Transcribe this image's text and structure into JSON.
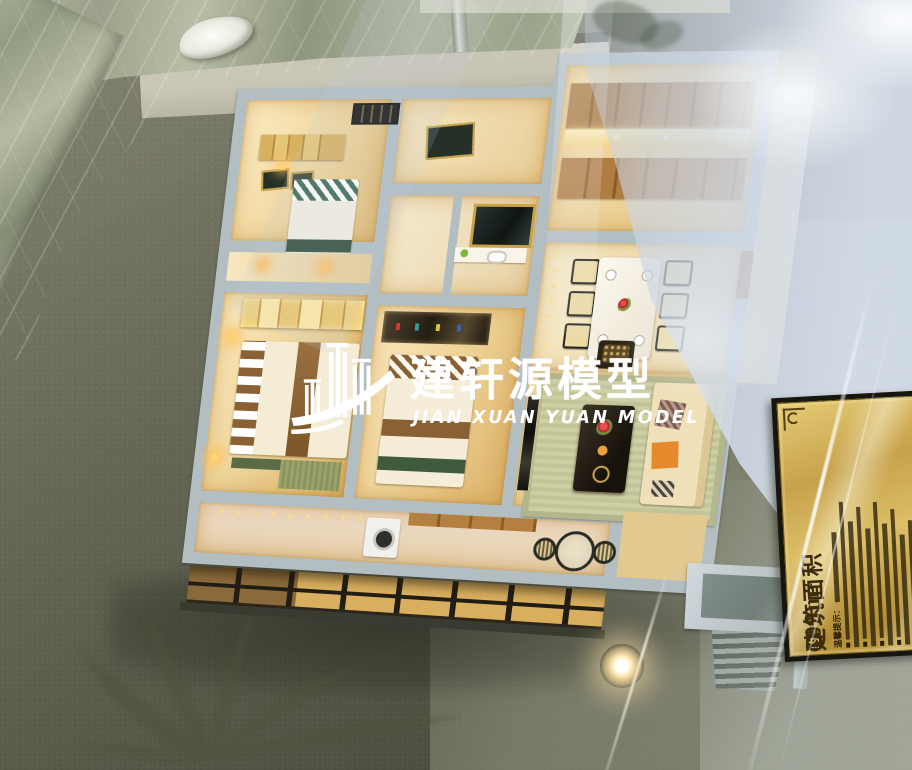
{
  "watermark": {
    "logo_icon": "buildings-swoosh-logo-icon",
    "title": "建轩源模型",
    "subtitle": "JIAN XUAN YUAN MODEL",
    "color": "#ffffff"
  },
  "plaque": {
    "title": "建筑面积",
    "approx_badge": "约",
    "area": "109m²",
    "tips_heading": "温馨提示：",
    "bg_color": "#c7a24b",
    "ink_color": "#3a2c0d"
  },
  "colors": {
    "wall-gray": "#b3bec3",
    "base-olive": "#6d6f5d",
    "base-dark": "#454637",
    "marble": "#a8ad97",
    "room-warm": "#f3dfae",
    "room-deep": "#dfb969",
    "wood": "#b07c42",
    "glow": "#ffd684",
    "haze": "#ccd6e4",
    "plaque-ink": "#3a2c0d",
    "wm-white": "#ffffff"
  }
}
